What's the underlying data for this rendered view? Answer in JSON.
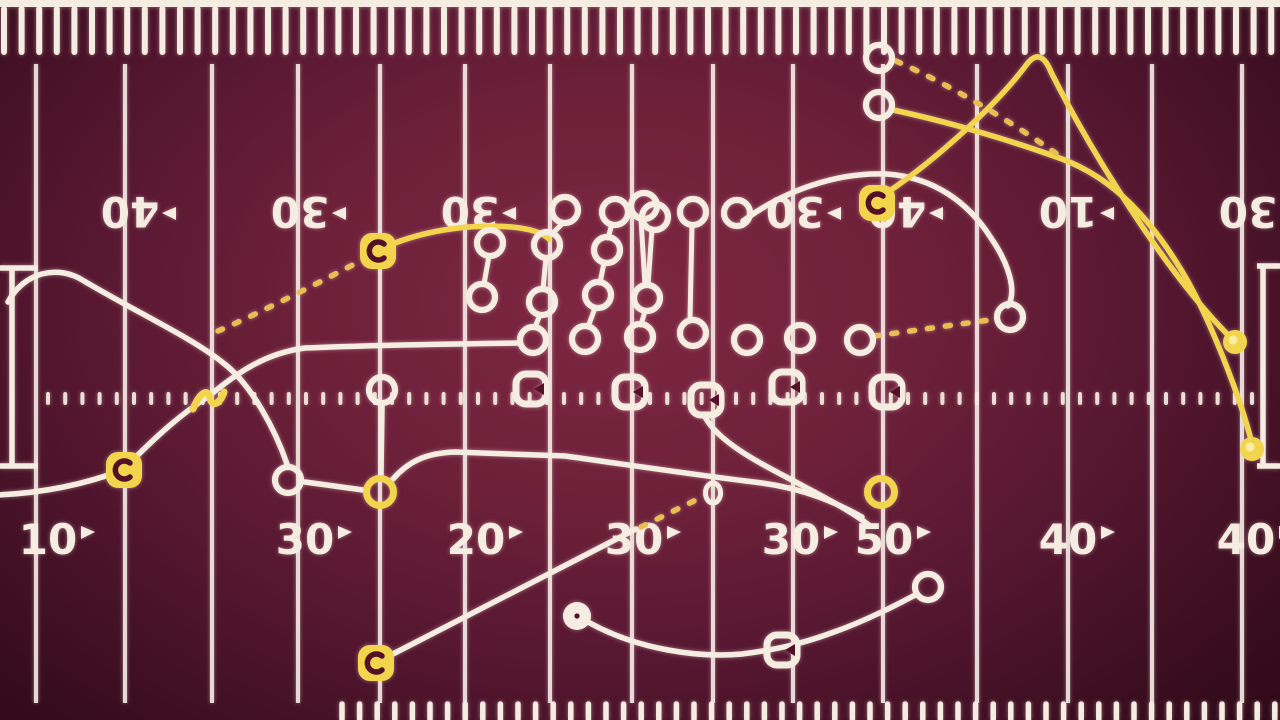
{
  "meta": {
    "description": "Football play diagram on dark maroon field",
    "width": 1280,
    "height": 720
  },
  "colors": {
    "field_dark": "#280714",
    "field_light": "#7e2743",
    "line": "#f5ece2",
    "line_dim": "rgba(246,238,232,0.88)",
    "yellow": "#f3d44d",
    "gold_dash": "#e8bd52",
    "maroon_glyph": "#531127"
  },
  "field": {
    "yard_lines_x": [
      36,
      125,
      212,
      298,
      380,
      465,
      550,
      632,
      713,
      793,
      883,
      977,
      1068,
      1152,
      1242
    ],
    "yard_line_top": 64,
    "yard_line_bottom": 703,
    "hash_row": {
      "y": 392,
      "h": 13,
      "w": 4,
      "start": 46,
      "end": 1254,
      "step": 17.2
    },
    "top_edge": {
      "bar_h": 7,
      "tick_y1": 9,
      "tick_y2": 52,
      "step": 17.6
    },
    "bottom_ticks": {
      "x_start": 342,
      "x_end": 1280,
      "y1": 704,
      "y2": 720,
      "step": 17.6
    },
    "left_bracket": "M 0,268 H 38 M 12,268 V 466 M 0,466 H 38",
    "right_bracket": "M 1257,266 H 1280 M 1263,266 V 466 M 1257,466 H 1280",
    "top_numbers": [
      {
        "label": "40",
        "x": 130
      },
      {
        "label": "30",
        "x": 300
      },
      {
        "label": "30",
        "x": 470
      },
      {
        "label": "30",
        "x": 795
      },
      {
        "label": "40",
        "x": 897
      },
      {
        "label": "10",
        "x": 1068
      },
      {
        "label": "30",
        "x": 1248
      }
    ],
    "top_numbers_y": 210,
    "bottom_numbers": [
      {
        "label": "10",
        "x": 48
      },
      {
        "label": "30",
        "x": 305
      },
      {
        "label": "20",
        "x": 476
      },
      {
        "label": "30",
        "x": 634
      },
      {
        "label": "30",
        "x": 791
      },
      {
        "label": "50",
        "x": 884
      },
      {
        "label": "40",
        "x": 1068
      },
      {
        "label": "40",
        "x": 1246
      }
    ],
    "bottom_numbers_y": 538
  },
  "routes": {
    "white_solid": [
      "M -4,495 C 45,493 85,484 123,470 C 160,432 183,413 209,396 C 238,372 266,353 305,348 C 370,345 450,344 518,343",
      "M 8,302 C 24,272 58,264 84,281 C 140,314 192,338 222,362 C 252,384 276,432 287,464",
      "M 305,482 L 363,490",
      "M 382,406 L 381,475",
      "M 393,479 C 408,462 425,453 455,452 L 565,456 C 650,468 710,477 762,483 C 805,489 835,502 862,517",
      "M 705,417 C 718,441 757,462 790,479 C 822,496 848,509 869,525",
      "M 389,656 L 636,529",
      "M 588,622 C 638,650 700,658 742,654 C 774,650 802,644 834,632 C 868,620 900,603 917,594",
      "M 743,221 C 785,190 838,172 886,174 C 934,177 969,203 991,238 C 1009,264 1017,291 1008,306"
    ],
    "white_stems": [
      "M 563,223 L 551,235",
      "M 612,224 L 608,238",
      "M 604,263 L 600,283",
      "M 595,308 L 588,327",
      "M 641,219 L 645,285",
      "M 652,229 L 648,285",
      "M 645,311 L 641,325",
      "M 692,225 L 690,320",
      "M 489,256 L 484,284",
      "M 546,258 L 543,289",
      "M 540,315 L 535,327"
    ],
    "yellow_solid": [
      "M 395,243 C 432,229 474,224 512,227 C 532,229 543,233 549,239",
      "M 888,192 C 934,161 996,106 1027,64 C 1037,51 1045,57 1051,72 C 1090,150 1165,272 1230,337",
      "M 893,110 C 945,121 1010,140 1062,159 C 1115,179 1152,220 1186,278 C 1216,331 1243,408 1251,440"
    ],
    "yellow_dashed": [
      "M 218,331 C 262,312 322,281 366,258",
      "M 896,61 C 952,86 1012,122 1064,159",
      "M 874,336 C 912,331 952,325 990,320",
      "M 641,527 L 700,498"
    ]
  },
  "players": {
    "white_circles": [
      [
        565,
        210
      ],
      [
        615,
        212
      ],
      [
        644,
        206
      ],
      [
        655,
        217
      ],
      [
        693,
        212
      ],
      [
        737,
        213
      ],
      [
        490,
        243
      ],
      [
        547,
        245
      ],
      [
        607,
        250
      ],
      [
        482,
        297
      ],
      [
        542,
        302
      ],
      [
        598,
        295
      ],
      [
        647,
        298
      ],
      [
        533,
        340
      ],
      [
        585,
        339
      ],
      [
        640,
        337
      ],
      [
        693,
        333
      ],
      [
        747,
        340
      ],
      [
        800,
        338
      ],
      [
        860,
        340
      ],
      [
        382,
        390
      ],
      [
        288,
        480
      ],
      [
        879,
        58
      ],
      [
        879,
        105
      ],
      [
        1010,
        317
      ],
      [
        928,
        587
      ]
    ],
    "white_squares": [
      [
        531,
        389
      ],
      [
        630,
        392
      ],
      [
        706,
        400
      ],
      [
        787,
        387
      ],
      [
        887,
        392
      ],
      [
        782,
        650
      ]
    ],
    "yellow_squares": [
      [
        378,
        251
      ],
      [
        124,
        470
      ],
      [
        376,
        663
      ],
      [
        877,
        203
      ]
    ],
    "yellow_circles": [
      [
        380,
        492
      ],
      [
        881,
        492
      ]
    ],
    "yellow_dots": [
      [
        1235,
        342
      ],
      [
        1252,
        449
      ]
    ],
    "white_disk": [
      577,
      616
    ],
    "small_oval": [
      713,
      493
    ],
    "squiggle": {
      "x": 207,
      "y": 396
    }
  }
}
